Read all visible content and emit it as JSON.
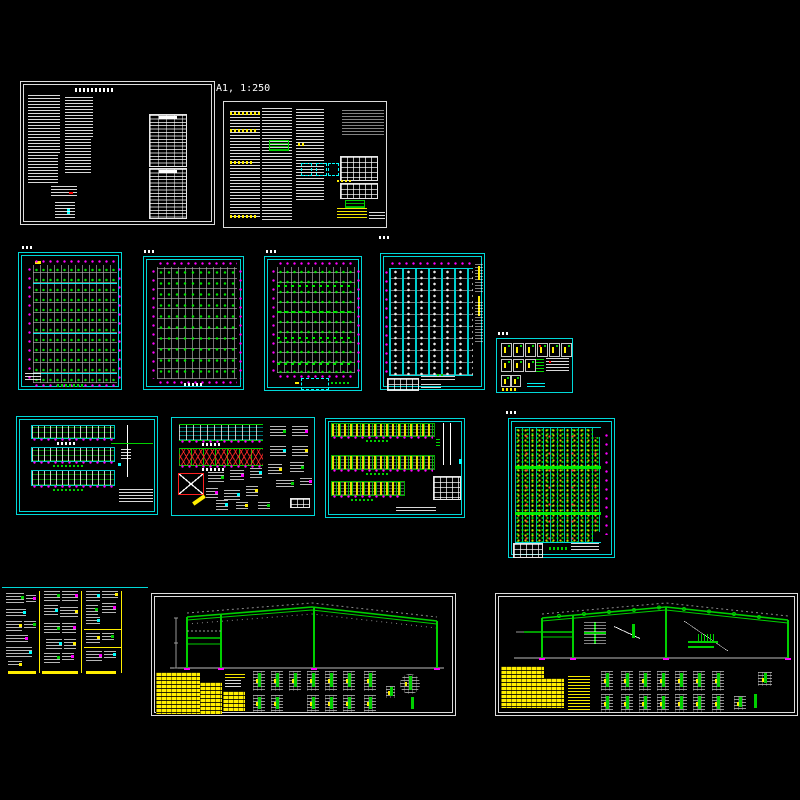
{
  "workspace": {
    "background_color": "#000000",
    "scale_label": "A1, 1:250",
    "palette": {
      "sheet_border_white": "#dcdcdc",
      "sheet_border_cyan": "#00d8d8",
      "grid_gray": "#a5a5a5",
      "member_green": "#00d000",
      "dimension_magenta": "#ff00ff",
      "highlight_yellow": "#ffee00",
      "bracing_red": "#ff2020",
      "text_white": "#ffffff"
    }
  }
}
